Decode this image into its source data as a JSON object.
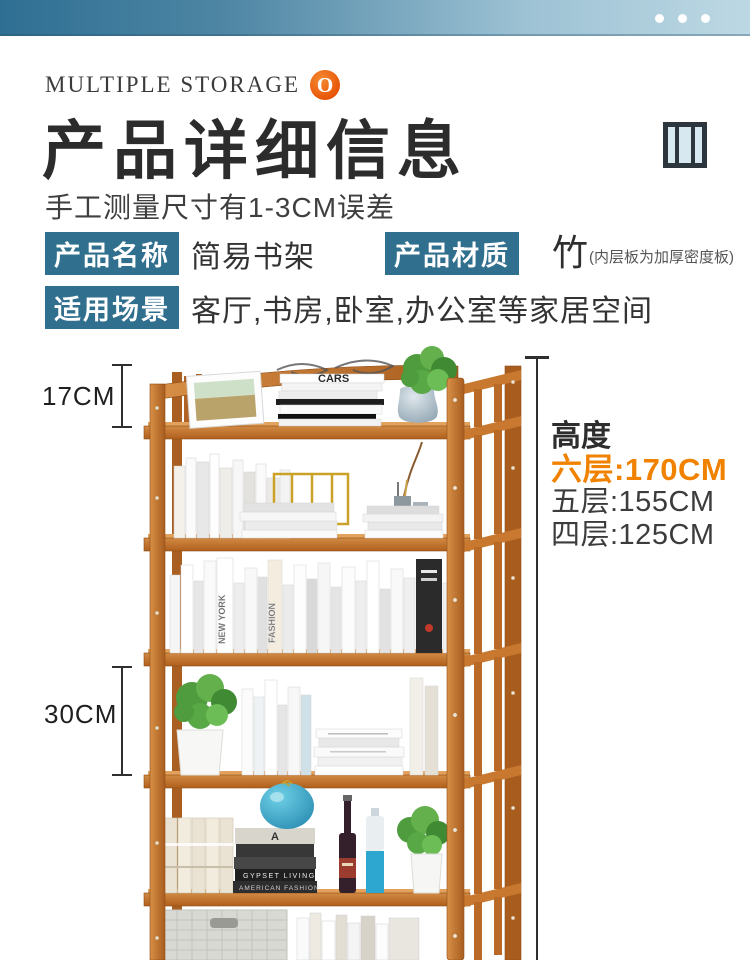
{
  "topbar": {
    "dots_count": 3
  },
  "header": {
    "brand": "MULTIPLE STORAGE",
    "logo_letter": "O",
    "title": "产品详细信息",
    "subtitle": "手工测量尺寸有1-3CM误差"
  },
  "specs": {
    "rows": [
      {
        "label": "产品名称",
        "value": "简易书架"
      },
      {
        "label": "产品材质",
        "value": "竹",
        "note": "(内层板为加厚密度板)"
      },
      {
        "label": "适用场景",
        "value": "客厅,书房,卧室,办公室等家居空间"
      }
    ]
  },
  "figure": {
    "dim_top": "17CM",
    "dim_mid": "30CM",
    "height_title": "高度",
    "heights": [
      {
        "text": "六层:170CM",
        "highlight": true
      },
      {
        "text": "五层:155CM",
        "highlight": false
      },
      {
        "text": "四层:125CM",
        "highlight": false
      }
    ],
    "photo_texts": {
      "cars": "CARS",
      "newyork": "NEW YORK",
      "fashion": "FASHION",
      "gypset": "GYPSET LIVING",
      "american": "AMERICAN FASHION",
      "letterA": "A"
    }
  },
  "colors": {
    "accent_orange": "#f08200",
    "badge_blue": "#316f8e",
    "topbar_start": "#2f6f93",
    "topbar_end": "#bdd8e4",
    "wood": "#c8732c"
  }
}
